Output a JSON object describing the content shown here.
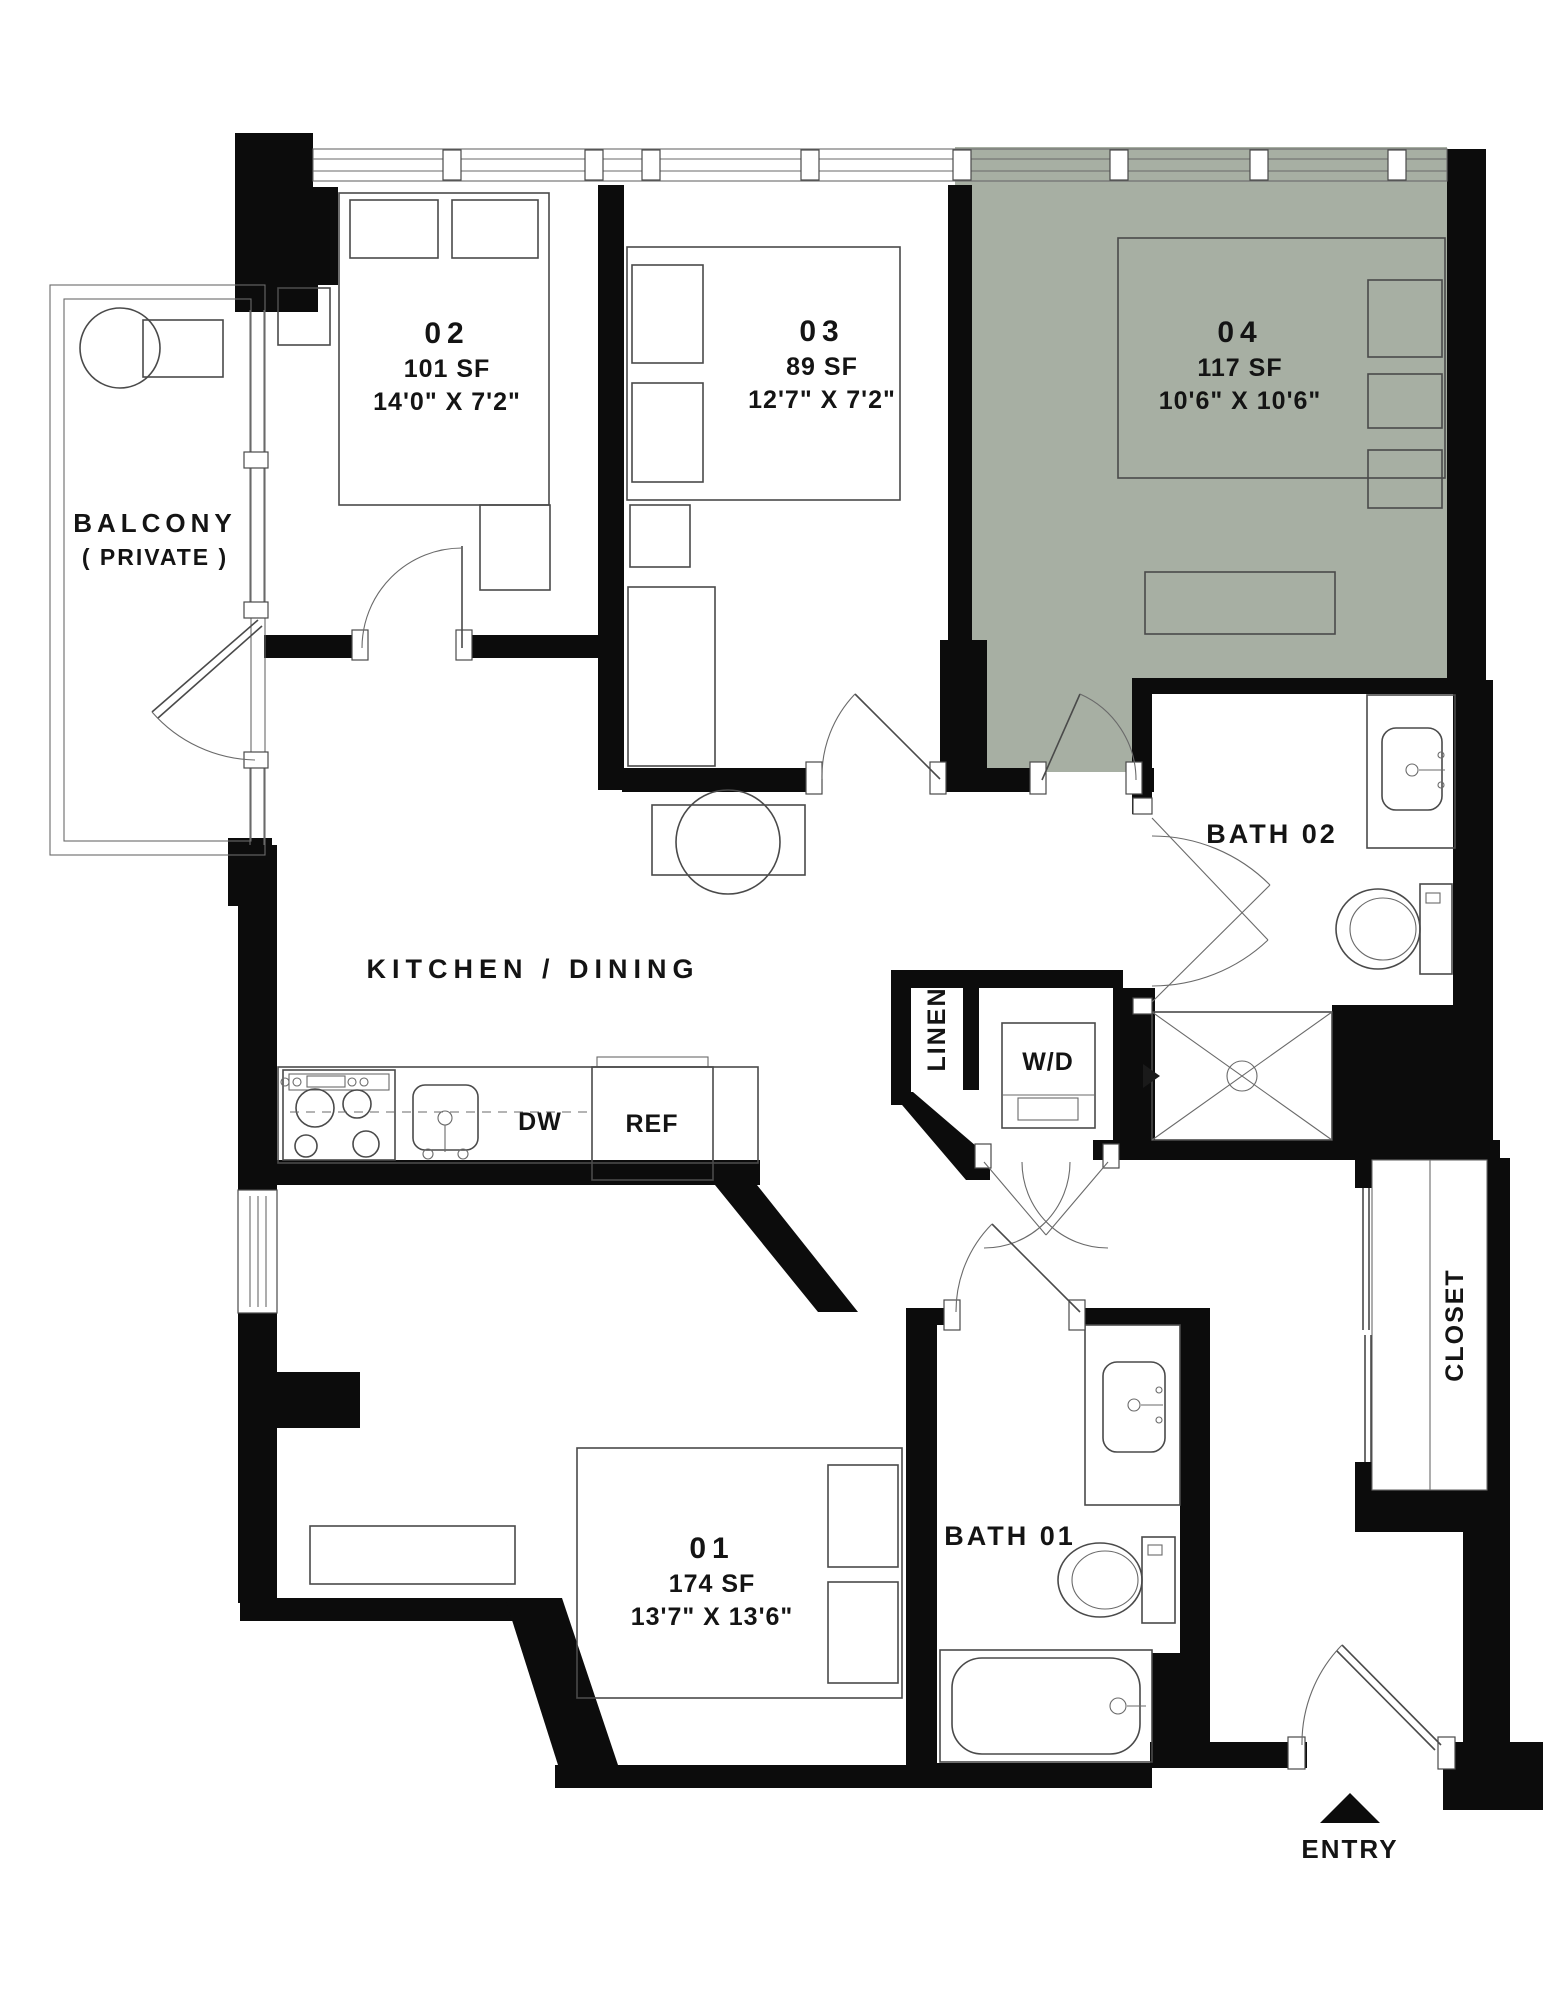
{
  "plan": {
    "rooms": {
      "bedroom2": {
        "number": "02",
        "area": "101 SF",
        "dims": "14'0\" X 7'2\""
      },
      "bedroom3": {
        "number": "03",
        "area": "89 SF",
        "dims": "12'7\" X 7'2\""
      },
      "bedroom4": {
        "number": "04",
        "area": "117 SF",
        "dims": "10'6\" X 10'6\""
      },
      "bedroom1": {
        "number": "01",
        "area": "174 SF",
        "dims": "13'7\" X 13'6\""
      }
    },
    "labels": {
      "kitchen": "KITCHEN / DINING",
      "bath1": "BATH 01",
      "bath2": "BATH 02",
      "balcony_line1": "BALCONY",
      "balcony_line2": "( PRIVATE )",
      "linen": "LINEN",
      "closet": "CLOSET",
      "washer_dryer": "W/D",
      "dishwasher": "DW",
      "refrigerator": "REF",
      "entry": "ENTRY"
    },
    "colors": {
      "highlight": "#a7afa3",
      "wall": "#0c0c0c",
      "line": "#4a4a4a"
    }
  }
}
